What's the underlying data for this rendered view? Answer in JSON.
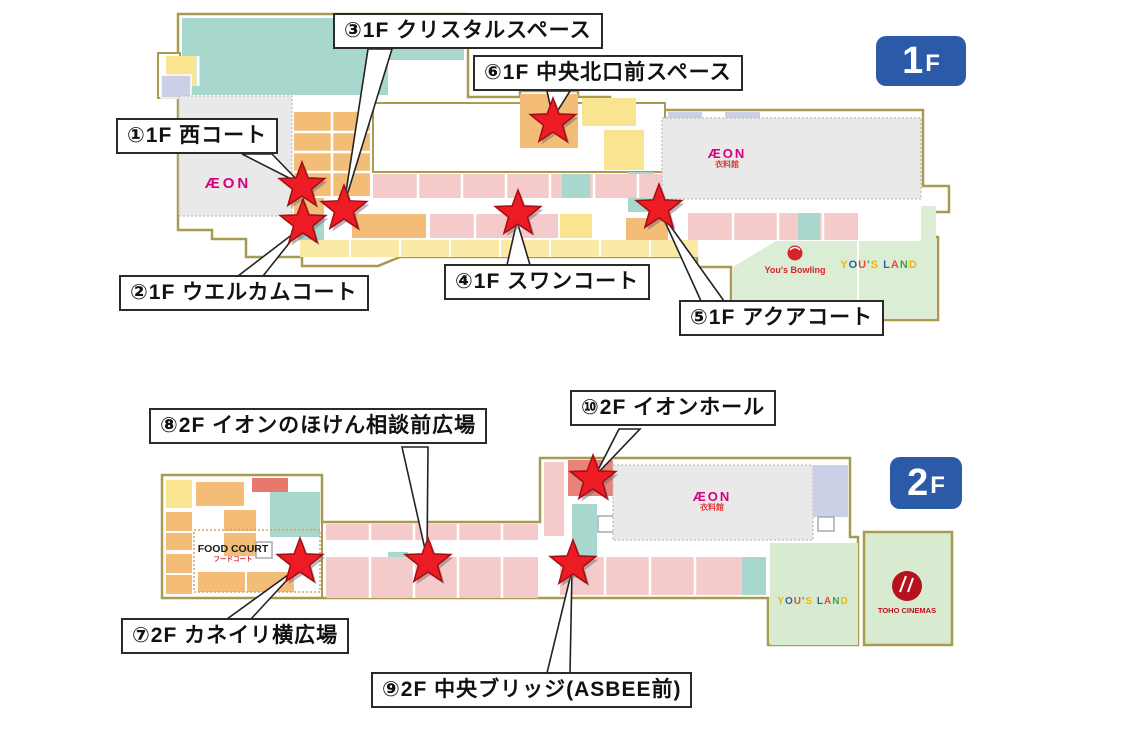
{
  "page": {
    "background": "#ffffff"
  },
  "colors": {
    "star_fill": "#ED1C24",
    "star_outline": "#A50D12",
    "badge_blue": "#2B5AA8",
    "aeon_pink": "#D6007F",
    "map_border_olive": "#A79B52",
    "shop_pink": "#F5CACA",
    "shop_teal": "#A8D7CD",
    "shop_orange": "#F3BD78",
    "shop_yellow": "#F9E48F",
    "shop_red": "#E8837A",
    "anchor_gray": "#E9E9E9",
    "amusement_green": "#DCEDD5",
    "yous_land_colors": [
      "#F2B705",
      "#2B62B0",
      "#E8483B",
      "#3FA33E"
    ]
  },
  "floor1": {
    "badge": {
      "digit": "1",
      "suffix": "F"
    },
    "markers": {
      "m1": {
        "label": "①1F 西コート"
      },
      "m2": {
        "label": "②1F ウエルカムコート"
      },
      "m3": {
        "label": "③1F クリスタルスペース"
      },
      "m4": {
        "label": "④1F スワンコート"
      },
      "m5": {
        "label": "⑤1F アクアコート"
      },
      "m6": {
        "label": "⑥1F 中央北口前スペース"
      }
    },
    "stores": {
      "aeon": {
        "label": "ÆON"
      },
      "aeon_clothing": {
        "main": "ÆON",
        "sub": "衣料館"
      },
      "yous_bowling": {
        "label": "You's Bowling"
      },
      "yous_land": {
        "label": "YOU'S LAND"
      }
    }
  },
  "floor2": {
    "badge": {
      "digit": "2",
      "suffix": "F"
    },
    "markers": {
      "m7": {
        "label": "⑦2F カネイリ横広場"
      },
      "m8": {
        "label": "⑧2F イオンのほけん相談前広場"
      },
      "m9": {
        "label": "⑨2F 中央ブリッジ(ASBEE前)"
      },
      "m10": {
        "label": "⑩2F イオンホール"
      }
    },
    "stores": {
      "food_court": {
        "main": "FOOD COURT",
        "sub": "フードコート"
      },
      "aeon_clothing": {
        "main": "ÆON",
        "sub": "衣料館"
      },
      "yous_land": {
        "label": "YOU'S LAND"
      },
      "toho": {
        "label": "TOHO CINEMAS"
      }
    }
  }
}
